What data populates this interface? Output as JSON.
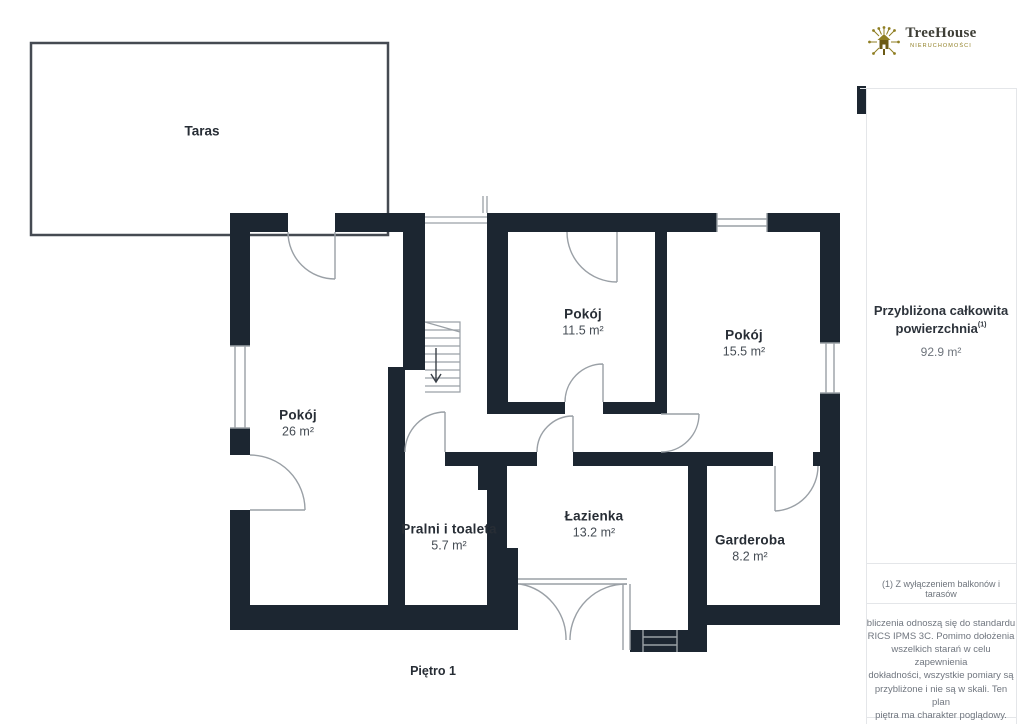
{
  "plan": {
    "title": "Piętro 1",
    "terrace_label": "Taras",
    "rooms": [
      {
        "name": "Pokój",
        "area": "11.5 m²"
      },
      {
        "name": "Pokój",
        "area": "15.5 m²"
      },
      {
        "name": "Pokój",
        "area": "26 m²"
      },
      {
        "name": "Pralni i toaleta",
        "area": "5.7 m²"
      },
      {
        "name": "Łazienka",
        "area": "13.2 m²"
      },
      {
        "name": "Garderoba",
        "area": "8.2 m²"
      }
    ]
  },
  "sidebar": {
    "logo": {
      "brand": "TreeHouse",
      "subtitle": "NIERUCHOMOŚCI",
      "icon": "tree-house-logo-icon"
    },
    "summary": {
      "line1": "Przybliżona całkowita",
      "line2": "powierzchnia",
      "sup": "(1)",
      "value": "92.9 m²"
    },
    "footnote": "(1) Z wyłączeniem balkonów i tarasów",
    "disclaimer_lines": [
      "bliczenia odnoszą się do standardu",
      "RICS IPMS 3C. Pomimo dołożenia",
      "wszelkich starań w celu zapewnienia",
      "dokładności, wszystkie pomiary są",
      "przybliżone i nie są w skali. Ten plan",
      "piętra ma charakter poglądowy."
    ],
    "watermark": {
      "name": "GIRAFFE",
      "suffix": "360"
    }
  },
  "colors": {
    "wall": "#1c2631",
    "thin_line": "#9aa0a6",
    "terrace_line": "#454a52",
    "accent_olive": "#8f7e22",
    "text_dark": "#272d35",
    "divider": "#e4e6e9"
  }
}
